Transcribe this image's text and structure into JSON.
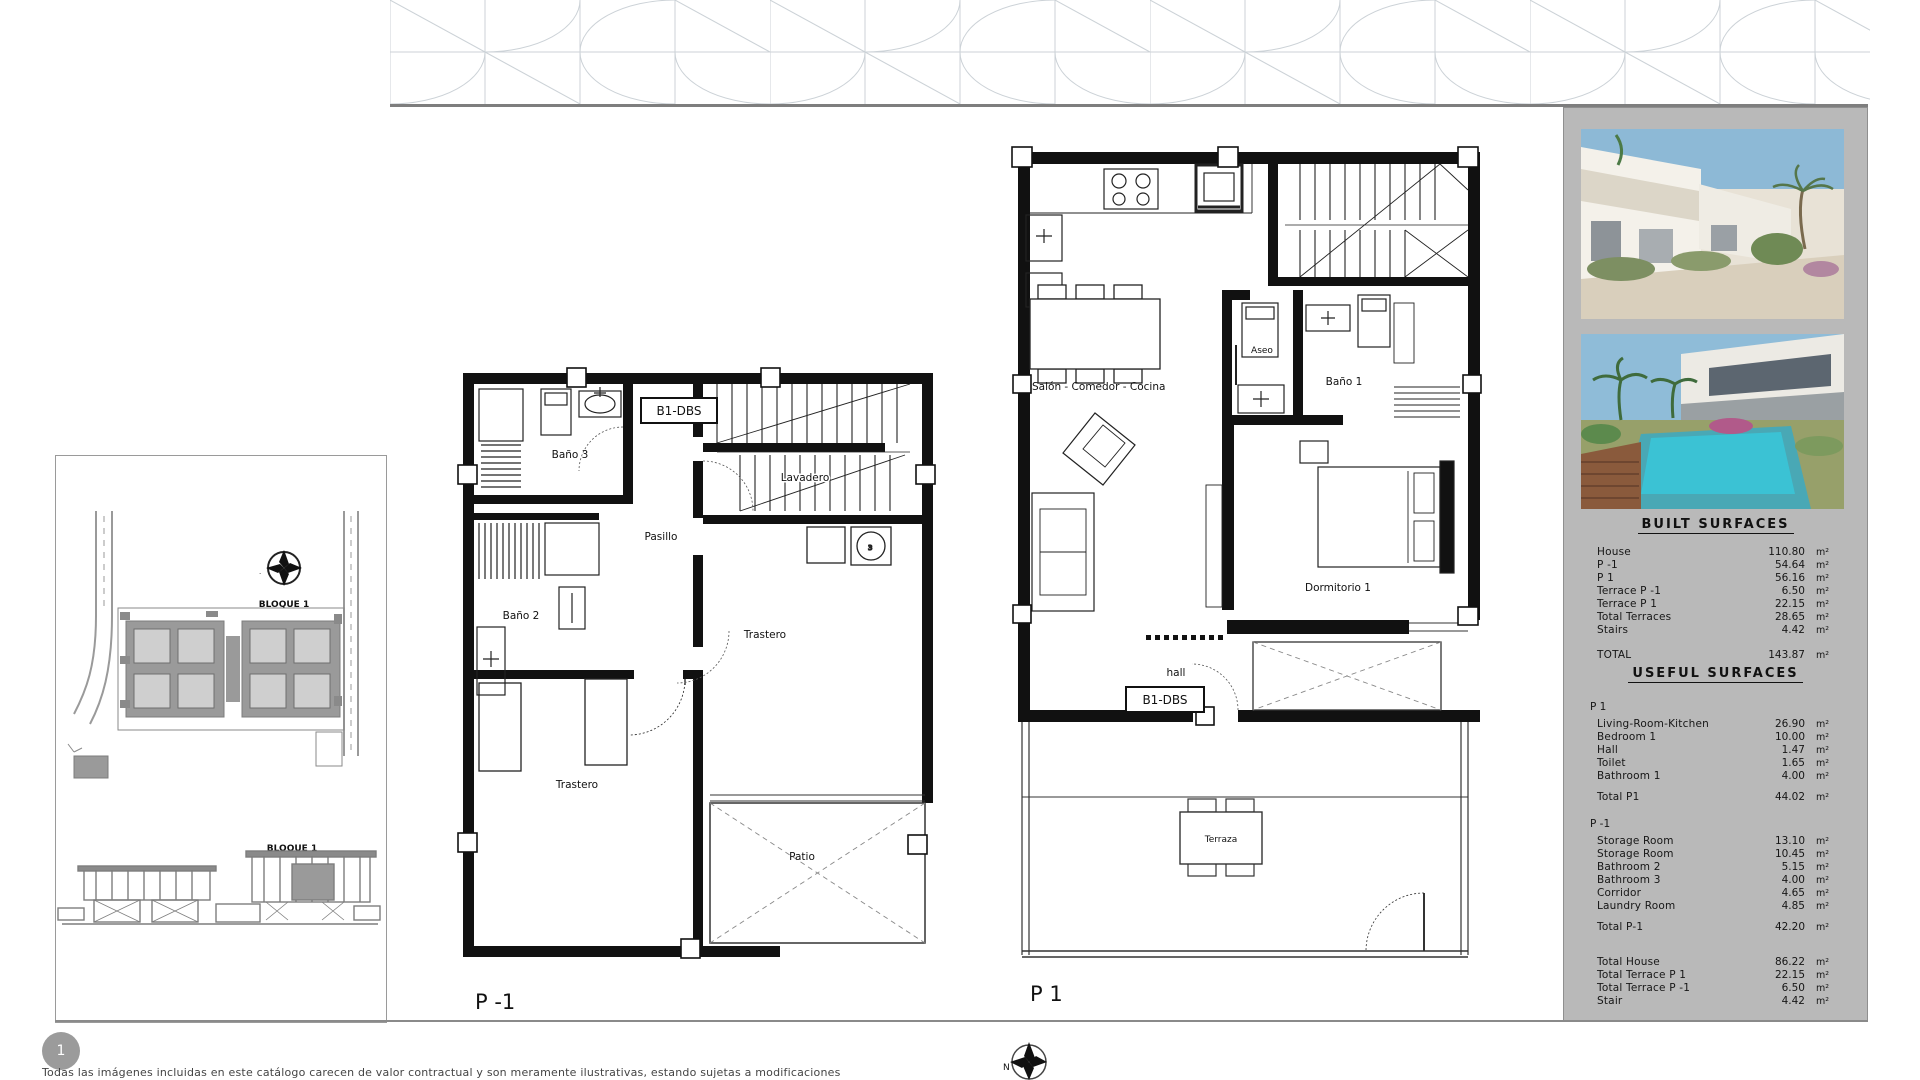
{
  "units": {
    "m2": "m²"
  },
  "page": {
    "badge": "1",
    "disclaimer": "Todas las imágenes incluidas en este catálogo carecen de valor contractual y son meramente ilustrativas, estando sujetas a modificaciones",
    "compass_north": "N"
  },
  "site_panel": {
    "bloque_top": "BLOQUE 1",
    "bloque_bottom": "BLOQUE 1"
  },
  "plans": {
    "pm1": {
      "title": "P -1",
      "unit_code": "B1-DBS",
      "rooms": {
        "bano3": "Baño 3",
        "lavadero": "Lavadero",
        "pasillo": "Pasillo",
        "bano2": "Baño 2",
        "trastero_right": "Trastero",
        "trastero_big": "Trastero",
        "patio": "Patio"
      }
    },
    "p1": {
      "title": "P 1",
      "unit_code": "B1-DBS",
      "rooms": {
        "salon": "Salón - Comedor - Cocina",
        "aseo": "Aseo",
        "bano1": "Baño 1",
        "dormitorio1": "Dormitorio 1",
        "hall": "hall",
        "terraza": "Terraza",
        "lav": "lav"
      }
    }
  },
  "built_surfaces": {
    "title": "BUILT SURFACES",
    "rows": [
      {
        "label": "House",
        "value": "110.80"
      },
      {
        "label": "P -1",
        "value": "54.64"
      },
      {
        "label": "P 1",
        "value": "56.16"
      },
      {
        "label": "Terrace  P -1",
        "value": "6.50"
      },
      {
        "label": "Terrace  P 1",
        "value": "22.15"
      },
      {
        "label": "Total Terraces",
        "value": "28.65"
      },
      {
        "label": "Stairs",
        "value": "4.42"
      }
    ],
    "total": {
      "label": "TOTAL",
      "value": "143.87"
    }
  },
  "useful_surfaces": {
    "title": "USEFUL SURFACES",
    "sections": [
      {
        "header": "P 1",
        "rows": [
          {
            "label": "Living-Room-Kitchen",
            "value": "26.90"
          },
          {
            "label": "Bedroom 1",
            "value": "10.00"
          },
          {
            "label": "Hall",
            "value": "1.47"
          },
          {
            "label": "Toilet",
            "value": "1.65"
          },
          {
            "label": "Bathroom 1",
            "value": "4.00"
          }
        ],
        "total": {
          "label": "Total  P1",
          "value": "44.02"
        }
      },
      {
        "header": "P -1",
        "rows": [
          {
            "label": "Storage Room",
            "value": "13.10"
          },
          {
            "label": "Storage Room",
            "value": "10.45"
          },
          {
            "label": "Bathroom 2",
            "value": "5.15"
          },
          {
            "label": "Bathroom 3",
            "value": "4.00"
          },
          {
            "label": "Corridor",
            "value": "4.65"
          },
          {
            "label": "Laundry Room",
            "value": "4.85"
          }
        ],
        "total": {
          "label": "Total  P-1",
          "value": "42.20"
        }
      }
    ],
    "grand_totals": [
      {
        "label": "Total  House",
        "value": "86.22"
      },
      {
        "label": "Total Terrace  P 1",
        "value": "22.15"
      },
      {
        "label": "Total Terrace  P -1",
        "value": "6.50"
      },
      {
        "label": "Stair",
        "value": "4.42"
      }
    ]
  }
}
